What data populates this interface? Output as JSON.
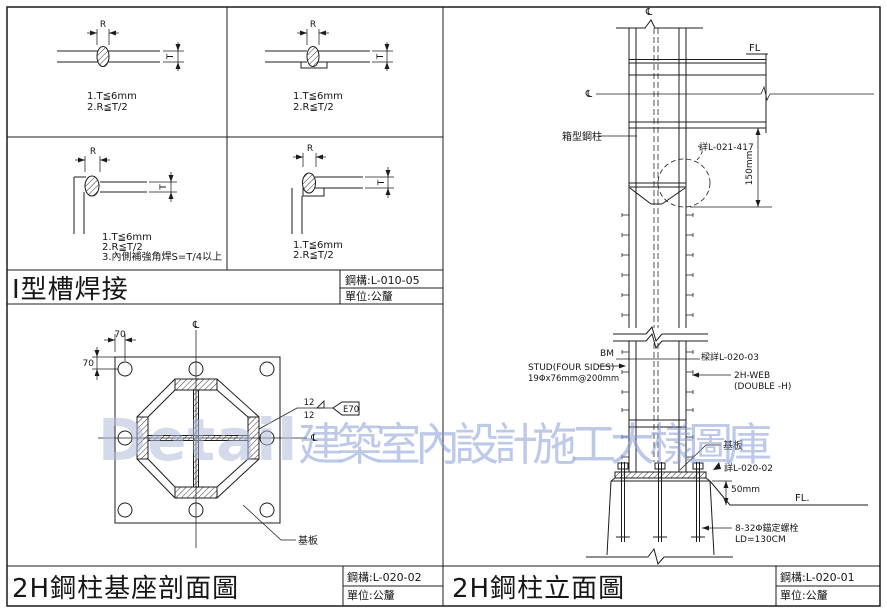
{
  "weld_section": {
    "title": "I型槽焊接",
    "drawing_no": "鋼構:L-010-05",
    "unit": "單位:公釐",
    "r_label": "R",
    "t_label": "T",
    "panel1": {
      "note1": "1.T≦6mm",
      "note2": "2.R≦T/2"
    },
    "panel2": {
      "note1": "1.T≦6mm",
      "note2": "2.R≦T/2"
    },
    "panel3": {
      "note1": "1.T≦6mm",
      "note2": "2.R≦T/2",
      "note3": "3.內側補強角焊S=T/4以上"
    },
    "panel4": {
      "note1": "1.T≦6mm",
      "note2": "2.R≦T/2"
    }
  },
  "base_section": {
    "title": "2H鋼柱基座剖面圖",
    "drawing_no": "鋼構:L-020-02",
    "unit": "單位:公釐",
    "centerline": "℄",
    "dim_edge_top": "70",
    "dim_edge_left": "70",
    "weld_size_top": "12",
    "weld_size_bottom": "12",
    "electrode": "E70",
    "base_plate_label": "基板"
  },
  "elevation": {
    "title": "2H鋼柱立面圖",
    "drawing_no": "鋼構:L-020-01",
    "unit": "單位:公釐",
    "centerline": "℄",
    "fl_top": "FL",
    "box_column_label": "箱型鋼柱",
    "bubble_ref": "詳L-021-417",
    "dim_splice": "150mm",
    "bm_label": "BM",
    "beam_ref": "樑詳L-020-03",
    "stud_note1": "STUD(FOUR SIDES)",
    "stud_note2": "19Φx76mm@200mm",
    "web_note1": "2H-WEB",
    "web_note2": "(DOUBLE -H)",
    "base_plate_label": "基板",
    "base_ref": "詳L-020-02",
    "dim_grout": "50mm",
    "fl_bottom": "FL.",
    "anchor_note1": "8-32Φ錨定螺栓",
    "anchor_note2": "LD=130CM"
  },
  "watermark": {
    "latin": "Detail",
    "cjk": "建築室內設計施工大樣圖庫"
  }
}
